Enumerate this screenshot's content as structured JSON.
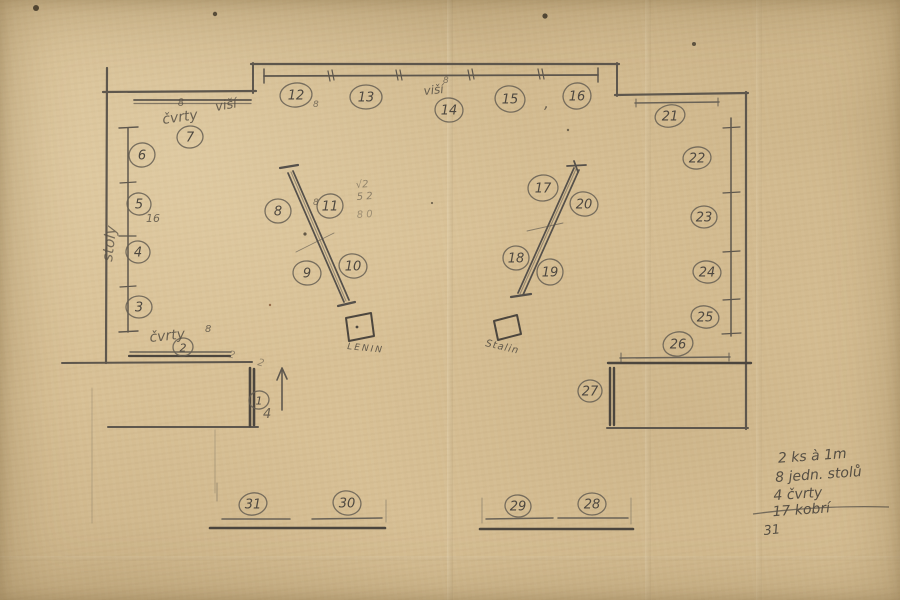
{
  "plan": {
    "seats": [
      {
        "n": "1",
        "x": 259,
        "y": 400,
        "rx": 10,
        "ry": 9
      },
      {
        "n": "2",
        "x": 183,
        "y": 347,
        "rx": 10,
        "ry": 9
      },
      {
        "n": "3",
        "x": 139,
        "y": 307,
        "rx": 13,
        "ry": 11
      },
      {
        "n": "4",
        "x": 138,
        "y": 252,
        "rx": 12,
        "ry": 11
      },
      {
        "n": "5",
        "x": 139,
        "y": 204,
        "rx": 12,
        "ry": 11
      },
      {
        "n": "6",
        "x": 142,
        "y": 155,
        "rx": 13,
        "ry": 12
      },
      {
        "n": "7",
        "x": 190,
        "y": 137,
        "rx": 13,
        "ry": 11
      },
      {
        "n": "8",
        "x": 278,
        "y": 211,
        "rx": 13,
        "ry": 12
      },
      {
        "n": "9",
        "x": 307,
        "y": 273,
        "rx": 14,
        "ry": 12
      },
      {
        "n": "10",
        "x": 353,
        "y": 266,
        "rx": 14,
        "ry": 12
      },
      {
        "n": "11",
        "x": 330,
        "y": 206,
        "rx": 13,
        "ry": 12
      },
      {
        "n": "12",
        "x": 296,
        "y": 95,
        "rx": 16,
        "ry": 12
      },
      {
        "n": "13",
        "x": 366,
        "y": 97,
        "rx": 16,
        "ry": 12
      },
      {
        "n": "14",
        "x": 449,
        "y": 110,
        "rx": 14,
        "ry": 12
      },
      {
        "n": "15",
        "x": 510,
        "y": 99,
        "rx": 15,
        "ry": 13
      },
      {
        "n": "16",
        "x": 577,
        "y": 96,
        "rx": 14,
        "ry": 13
      },
      {
        "n": "17",
        "x": 543,
        "y": 188,
        "rx": 15,
        "ry": 13
      },
      {
        "n": "18",
        "x": 516,
        "y": 258,
        "rx": 13,
        "ry": 12
      },
      {
        "n": "19",
        "x": 550,
        "y": 272,
        "rx": 13,
        "ry": 13
      },
      {
        "n": "20",
        "x": 584,
        "y": 204,
        "rx": 14,
        "ry": 12
      },
      {
        "n": "21",
        "x": 670,
        "y": 116,
        "rx": 15,
        "ry": 11
      },
      {
        "n": "22",
        "x": 697,
        "y": 158,
        "rx": 14,
        "ry": 11
      },
      {
        "n": "23",
        "x": 704,
        "y": 217,
        "rx": 13,
        "ry": 11
      },
      {
        "n": "24",
        "x": 707,
        "y": 272,
        "rx": 14,
        "ry": 11
      },
      {
        "n": "25",
        "x": 705,
        "y": 317,
        "rx": 14,
        "ry": 11
      },
      {
        "n": "26",
        "x": 678,
        "y": 344,
        "rx": 15,
        "ry": 12
      },
      {
        "n": "27",
        "x": 590,
        "y": 391,
        "rx": 12,
        "ry": 11
      },
      {
        "n": "28",
        "x": 592,
        "y": 504,
        "rx": 14,
        "ry": 11
      },
      {
        "n": "29",
        "x": 518,
        "y": 506,
        "rx": 13,
        "ry": 11
      },
      {
        "n": "30",
        "x": 347,
        "y": 503,
        "rx": 14,
        "ry": 12
      },
      {
        "n": "31",
        "x": 253,
        "y": 504,
        "rx": 14,
        "ry": 11
      }
    ],
    "labels": [
      {
        "t": "stoly",
        "x": 112,
        "y": 262,
        "s": 15,
        "r": -83,
        "o": 0.75
      },
      {
        "t": "8",
        "x": 178,
        "y": 106,
        "s": 10,
        "r": -5,
        "o": 0.8
      },
      {
        "t": "čvrty",
        "x": 163,
        "y": 124,
        "s": 14,
        "r": -8,
        "o": 0.85
      },
      {
        "t": "viší",
        "x": 216,
        "y": 111,
        "s": 13,
        "r": -10,
        "o": 0.85
      },
      {
        "t": "viší",
        "x": 424,
        "y": 95,
        "s": 12,
        "r": -6,
        "o": 0.85
      },
      {
        "t": "8",
        "x": 443,
        "y": 83,
        "s": 9,
        "r": 0,
        "o": 0.7
      },
      {
        "t": "8",
        "x": 313,
        "y": 107,
        "s": 9,
        "r": 0,
        "o": 0.7
      },
      {
        "t": ",",
        "x": 544,
        "y": 108,
        "s": 16,
        "r": 0,
        "o": 0.8
      },
      {
        "t": "8",
        "x": 313,
        "y": 205,
        "s": 9,
        "r": 0,
        "o": 0.7
      },
      {
        "t": "√2",
        "x": 356,
        "y": 188,
        "s": 10,
        "r": -4,
        "o": 0.55
      },
      {
        "t": "5 2",
        "x": 357,
        "y": 200,
        "s": 10,
        "r": -4,
        "o": 0.6
      },
      {
        "t": "8 0",
        "x": 357,
        "y": 218,
        "s": 10,
        "r": -4,
        "o": 0.45
      },
      {
        "t": "16",
        "x": 146,
        "y": 222,
        "s": 11,
        "r": 0,
        "o": 0.8
      },
      {
        "t": "čvrty",
        "x": 150,
        "y": 342,
        "s": 14,
        "r": -6,
        "o": 0.85
      },
      {
        "t": "8",
        "x": 205,
        "y": 332,
        "s": 10,
        "r": 0,
        "o": 0.8
      },
      {
        "t": "2",
        "x": 228,
        "y": 357,
        "s": 10,
        "r": 15,
        "o": 0.55
      },
      {
        "t": "2",
        "x": 257,
        "y": 365,
        "s": 10,
        "r": 15,
        "o": 0.55
      },
      {
        "t": "4",
        "x": 263,
        "y": 418,
        "s": 13,
        "r": 0,
        "o": 0.85
      },
      {
        "t": "LENIN",
        "x": 347,
        "y": 349,
        "s": 9,
        "r": 6,
        "o": 0.9,
        "ls": 2
      },
      {
        "t": "Stalin",
        "x": 485,
        "y": 346,
        "s": 10,
        "r": 13,
        "o": 0.9,
        "ls": 1
      }
    ]
  },
  "notes": {
    "lines": [
      "2 ks à 1m",
      "8 jedn. stolů",
      "4 čvrty",
      "17 kobrí"
    ],
    "total": "31"
  }
}
